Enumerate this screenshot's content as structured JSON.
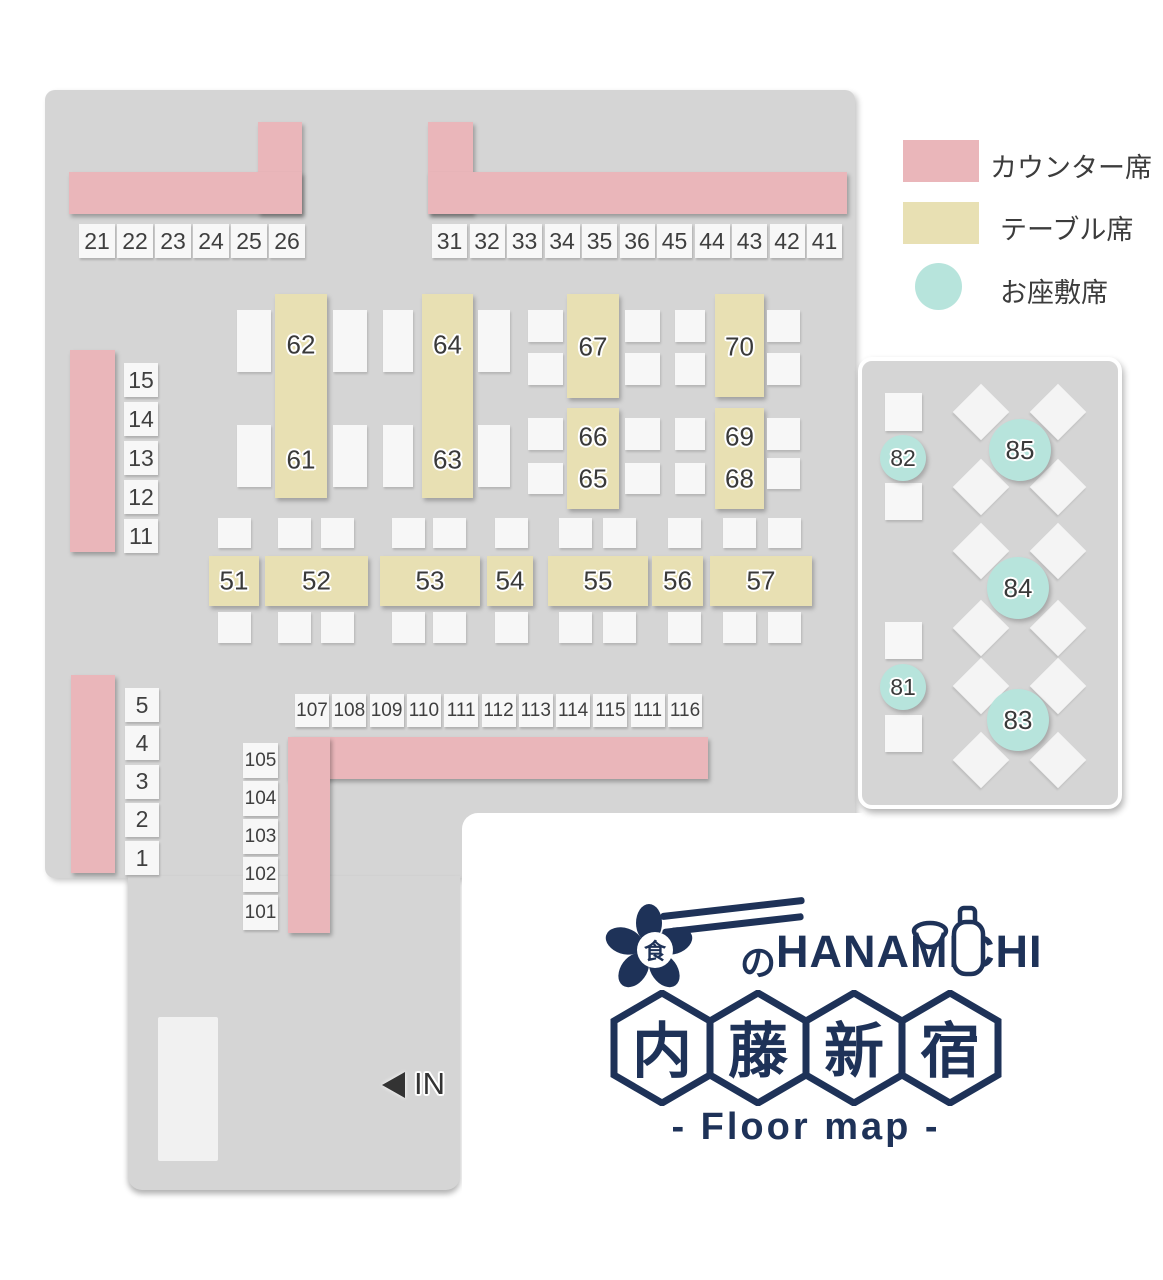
{
  "colors": {
    "floor": "#d5d5d5",
    "counter": "#eab6ba",
    "table": "#e8e0b3",
    "zashiki": "#b7e4dc",
    "seat": "#f7f7f7",
    "navy": "#1e3258",
    "text": "#3c3c3c"
  },
  "legend": {
    "items": [
      {
        "type": "counter",
        "label": "カウンター席"
      },
      {
        "type": "table",
        "label": "テーブル席"
      },
      {
        "type": "zashiki",
        "label": "お座敷席"
      }
    ]
  },
  "entrance": {
    "label": "IN"
  },
  "logo": {
    "flower_char": "食",
    "no_char": "の",
    "name": "HANAMICHI",
    "hex_chars": [
      "内",
      "藤",
      "新",
      "宿"
    ],
    "subtitle": "- Floor map -"
  },
  "map": {
    "counters": [
      [
        258,
        122,
        44,
        92
      ],
      [
        69,
        172,
        233,
        42
      ],
      [
        428,
        122,
        45,
        92
      ],
      [
        428,
        172,
        419,
        42
      ],
      [
        70,
        350,
        45,
        202
      ],
      [
        71,
        675,
        44,
        198
      ],
      [
        288,
        737,
        420,
        42
      ],
      [
        288,
        737,
        42,
        196
      ]
    ],
    "seat_groups": [
      {
        "id": "top-left",
        "x": 79,
        "y": 224,
        "w": 36,
        "h": 34,
        "dx": 38,
        "dy": 0,
        "fs": 23,
        "labels": [
          "21",
          "22",
          "23",
          "24",
          "25",
          "26"
        ]
      },
      {
        "id": "top-right",
        "x": 432,
        "y": 224,
        "w": 35,
        "h": 34,
        "dx": 37.5,
        "dy": 0,
        "fs": 23,
        "labels": [
          "31",
          "32",
          "33",
          "34",
          "35",
          "36",
          "45",
          "44",
          "43",
          "42",
          "41"
        ]
      },
      {
        "id": "left-mid",
        "x": 124,
        "y": 363,
        "w": 34,
        "h": 34,
        "dx": 0,
        "dy": 39,
        "fs": 23,
        "labels": [
          "15",
          "14",
          "13",
          "12",
          "11"
        ]
      },
      {
        "id": "left-bottom",
        "x": 125,
        "y": 688,
        "w": 34,
        "h": 34,
        "dx": 0,
        "dy": 38.3,
        "fs": 23,
        "labels": [
          "5",
          "4",
          "3",
          "2",
          "1"
        ]
      },
      {
        "id": "bottom-row",
        "x": 295,
        "y": 694,
        "w": 34,
        "h": 33,
        "dx": 37.3,
        "dy": 0,
        "fs": 19,
        "labels": [
          "107",
          "108",
          "109",
          "110",
          "111",
          "112",
          "113",
          "114",
          "115",
          "111",
          "116"
        ]
      },
      {
        "id": "bottom-col",
        "x": 243,
        "y": 743,
        "w": 35,
        "h": 35,
        "dx": 0,
        "dy": 38,
        "fs": 19,
        "labels": [
          "105",
          "104",
          "103",
          "102",
          "101"
        ]
      }
    ],
    "tables": [
      {
        "x": 275,
        "y": 294,
        "w": 52,
        "h": 204,
        "labels": [
          {
            "t": "62",
            "cy": 51
          },
          {
            "t": "61",
            "cy": 166
          }
        ]
      },
      {
        "x": 422,
        "y": 294,
        "w": 51,
        "h": 204,
        "labels": [
          {
            "t": "64",
            "cy": 51
          },
          {
            "t": "63",
            "cy": 166
          }
        ]
      },
      {
        "x": 567,
        "y": 294,
        "w": 52,
        "h": 104,
        "labels": [
          {
            "t": "67",
            "cy": 53
          }
        ]
      },
      {
        "x": 567,
        "y": 408,
        "w": 52,
        "h": 101,
        "labels": [
          {
            "t": "66",
            "cy": 29
          },
          {
            "t": "65",
            "cy": 71
          }
        ]
      },
      {
        "x": 715,
        "y": 294,
        "w": 49,
        "h": 103,
        "labels": [
          {
            "t": "70",
            "cy": 53
          }
        ]
      },
      {
        "x": 715,
        "y": 408,
        "w": 49,
        "h": 101,
        "labels": [
          {
            "t": "69",
            "cy": 29
          },
          {
            "t": "68",
            "cy": 71
          }
        ]
      },
      {
        "x": 209,
        "y": 556,
        "w": 50,
        "h": 50,
        "labels": [
          {
            "t": "51",
            "cy": 25
          }
        ]
      },
      {
        "x": 265,
        "y": 556,
        "w": 103,
        "h": 50,
        "labels": [
          {
            "t": "52",
            "cy": 25
          }
        ]
      },
      {
        "x": 380,
        "y": 556,
        "w": 100,
        "h": 50,
        "labels": [
          {
            "t": "53",
            "cy": 25
          }
        ]
      },
      {
        "x": 487,
        "y": 556,
        "w": 46,
        "h": 50,
        "labels": [
          {
            "t": "54",
            "cy": 25
          }
        ]
      },
      {
        "x": 548,
        "y": 556,
        "w": 100,
        "h": 50,
        "labels": [
          {
            "t": "55",
            "cy": 25
          }
        ]
      },
      {
        "x": 652,
        "y": 556,
        "w": 51,
        "h": 50,
        "labels": [
          {
            "t": "56",
            "cy": 25
          }
        ]
      },
      {
        "x": 710,
        "y": 556,
        "w": 102,
        "h": 50,
        "labels": [
          {
            "t": "57",
            "cy": 25
          }
        ]
      }
    ],
    "plain_seats": [
      [
        237,
        310,
        34,
        62
      ],
      [
        333,
        310,
        34,
        62
      ],
      [
        237,
        425,
        34,
        62
      ],
      [
        333,
        425,
        34,
        62
      ],
      [
        383,
        310,
        30,
        62
      ],
      [
        478,
        310,
        32,
        62
      ],
      [
        383,
        425,
        30,
        62
      ],
      [
        478,
        425,
        32,
        62
      ],
      [
        528,
        310,
        35,
        32
      ],
      [
        528,
        353,
        35,
        32
      ],
      [
        528,
        418,
        35,
        32
      ],
      [
        528,
        463,
        35,
        31
      ],
      [
        625,
        310,
        35,
        32
      ],
      [
        625,
        353,
        35,
        32
      ],
      [
        625,
        418,
        35,
        32
      ],
      [
        625,
        463,
        35,
        31
      ],
      [
        675,
        310,
        30,
        32
      ],
      [
        675,
        353,
        30,
        32
      ],
      [
        675,
        418,
        30,
        32
      ],
      [
        675,
        463,
        30,
        31
      ],
      [
        767,
        310,
        33,
        32
      ],
      [
        767,
        353,
        33,
        32
      ],
      [
        767,
        418,
        33,
        32
      ],
      [
        767,
        458,
        33,
        31
      ],
      [
        218,
        518,
        33,
        30
      ],
      [
        278,
        518,
        33,
        30
      ],
      [
        321,
        518,
        33,
        30
      ],
      [
        392,
        518,
        33,
        30
      ],
      [
        433,
        518,
        33,
        30
      ],
      [
        495,
        518,
        33,
        30
      ],
      [
        559,
        518,
        33,
        30
      ],
      [
        603,
        518,
        33,
        30
      ],
      [
        668,
        518,
        33,
        30
      ],
      [
        723,
        518,
        33,
        30
      ],
      [
        768,
        518,
        33,
        30
      ],
      [
        218,
        612,
        33,
        31
      ],
      [
        278,
        612,
        33,
        31
      ],
      [
        321,
        612,
        33,
        31
      ],
      [
        392,
        612,
        33,
        31
      ],
      [
        433,
        612,
        33,
        31
      ],
      [
        495,
        612,
        33,
        31
      ],
      [
        559,
        612,
        33,
        31
      ],
      [
        603,
        612,
        33,
        31
      ],
      [
        668,
        612,
        33,
        31
      ],
      [
        723,
        612,
        33,
        31
      ],
      [
        768,
        612,
        33,
        31
      ],
      [
        885,
        393,
        37,
        38
      ],
      [
        885,
        483,
        37,
        37
      ],
      [
        885,
        622,
        37,
        37
      ],
      [
        885,
        715,
        37,
        37
      ]
    ],
    "diamonds": [
      [
        961,
        392
      ],
      [
        1038,
        392
      ],
      [
        961,
        467
      ],
      [
        1038,
        467
      ],
      [
        961,
        531
      ],
      [
        1038,
        531
      ],
      [
        961,
        608
      ],
      [
        1038,
        608
      ],
      [
        961,
        666
      ],
      [
        1038,
        666
      ],
      [
        961,
        740
      ],
      [
        1038,
        740
      ]
    ],
    "zashiki_seats": [
      {
        "label": "85",
        "cx": 1020,
        "cy": 450,
        "r": 31
      },
      {
        "label": "84",
        "cx": 1018,
        "cy": 588,
        "r": 31
      },
      {
        "label": "83",
        "cx": 1018,
        "cy": 720,
        "r": 31
      },
      {
        "label": "82",
        "cx": 903,
        "cy": 458,
        "r": 23
      },
      {
        "label": "81",
        "cx": 903,
        "cy": 687,
        "r": 23
      }
    ],
    "door": [
      158,
      1017,
      60,
      144
    ]
  }
}
